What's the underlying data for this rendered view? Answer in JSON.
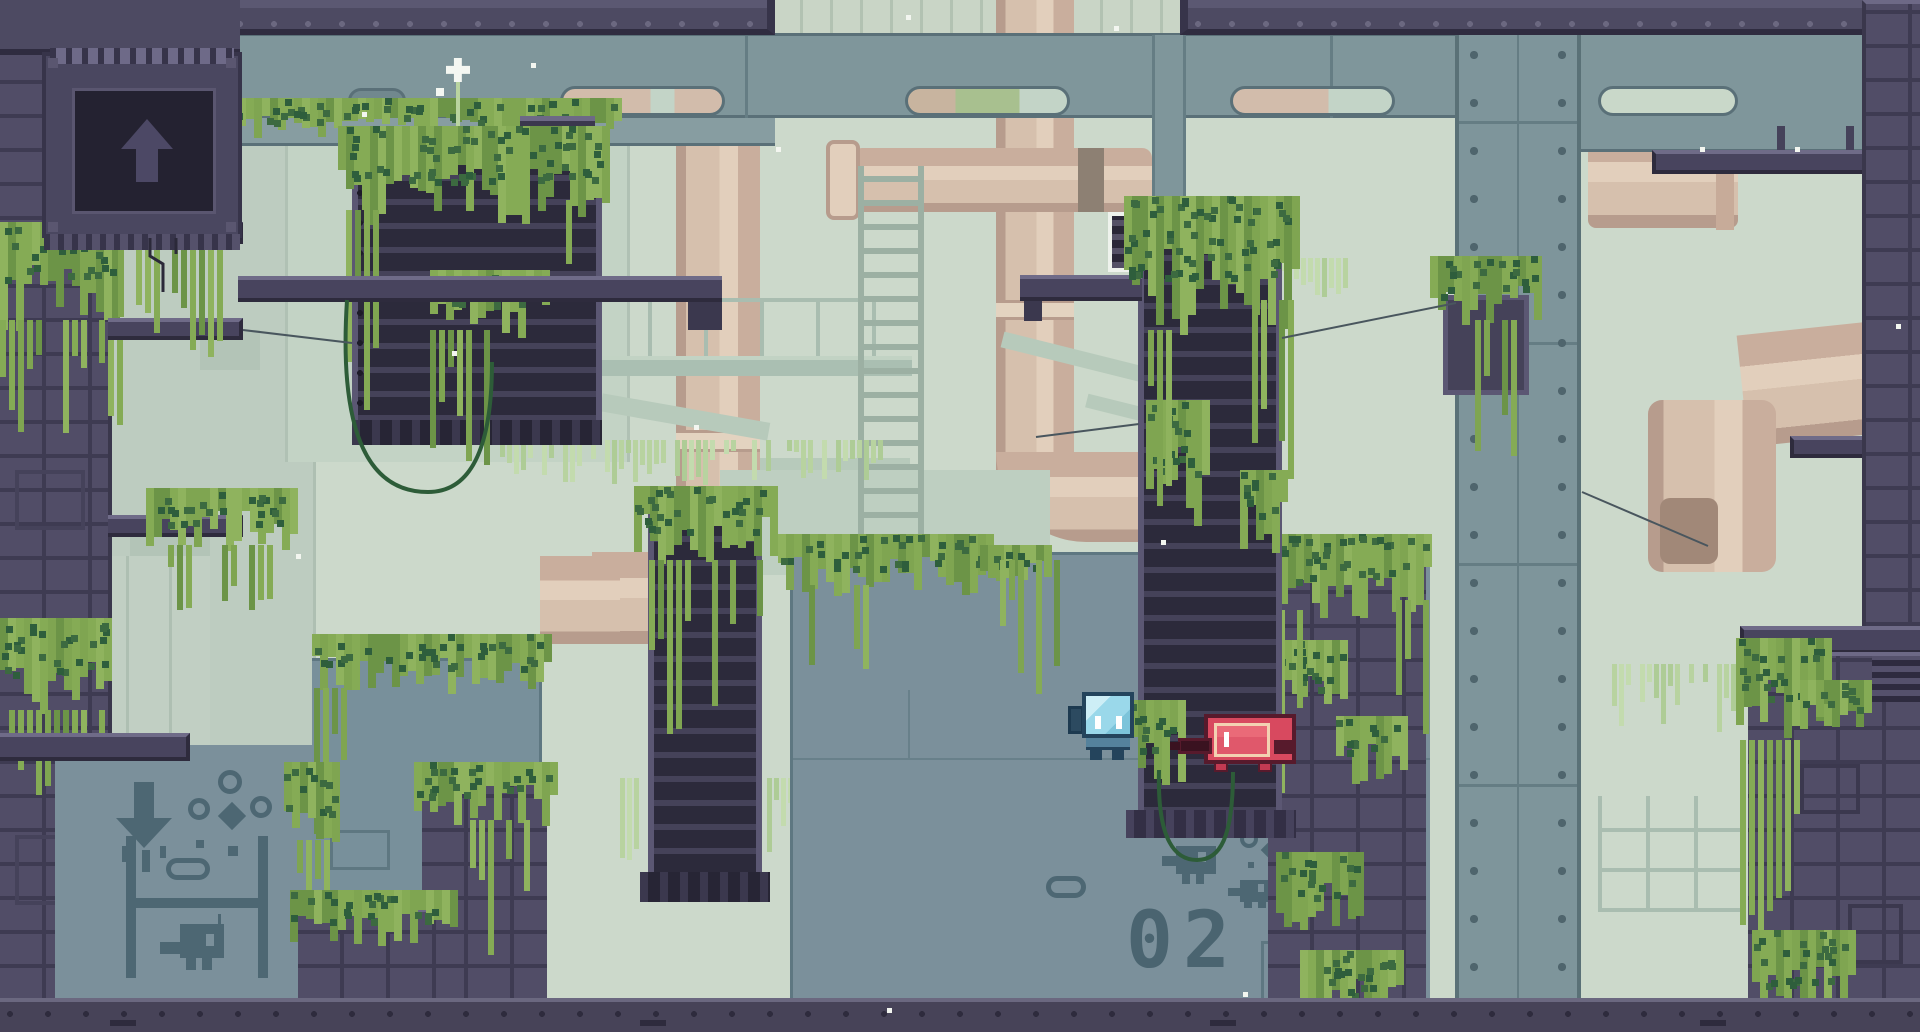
{
  "scene": {
    "description": "Pixel-art platformer level: overgrown industrial facility with mossy ruins, tan pipes, steel girders and two small robot characters",
    "area_stencil": "02"
  },
  "signs": {
    "exit_panel": {
      "icon": "up-arrow",
      "location": "top-left dark panel"
    },
    "wall_marking_arrow": {
      "icon": "down-arrow",
      "location": "bottom-left wall"
    },
    "area_stencil": "02"
  },
  "characters": {
    "blue_robot": {
      "label": "blue robot",
      "facing": "right"
    },
    "red_robot": {
      "label": "red robot",
      "facing": "left"
    }
  },
  "palette": {
    "background": "#ccd9cb",
    "background_silhouette": "#bdccc0",
    "pipe_tan": "#d6c0ad",
    "steel_teal": "#7f969b",
    "structure_purple": "#514d67",
    "structure_dark": "#2c2a3b",
    "wall_gray": "#7b909b",
    "marking_slate": "#4d6773",
    "moss_green": "#7fa551",
    "moss_dark": "#3c6a40",
    "pale_moss": "#b8d3a0",
    "floor_dark": "#474358",
    "cable_green": "#2d5c38",
    "player_blue": "#8ed2e4",
    "player_red": "#d8495f",
    "door_white": "#eef2ec"
  }
}
